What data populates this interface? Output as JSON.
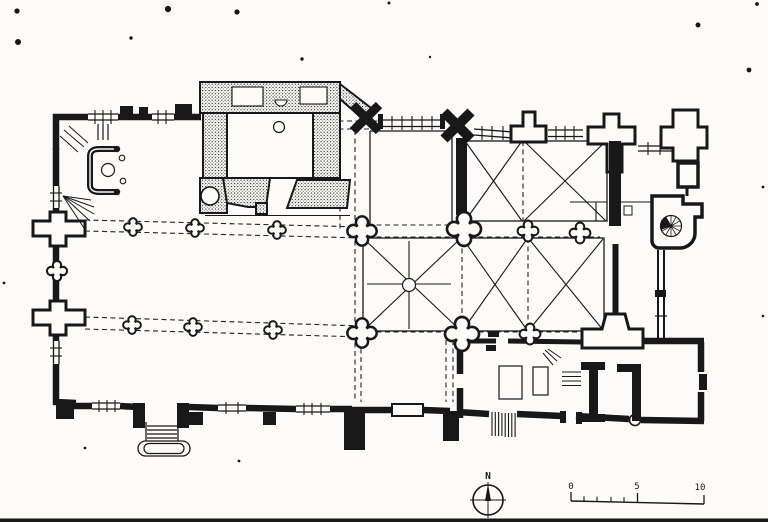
{
  "document": {
    "kind": "scanned architectural floor plan",
    "subject": "church ground plan (nave with aisles, choir with cross-vaulted bays, west apse, stippled chapel block, spiral stair turret, sacristy rooms)"
  },
  "colors": {
    "paper": "#fcfbf9",
    "ink": "#181818",
    "stipple": "#1a1a1a"
  },
  "compass": {
    "north_label": "N"
  },
  "scale_bar": {
    "labels": [
      "0",
      "5",
      "10"
    ],
    "minor_ticks_between_0_and_5": 4
  },
  "icons": [
    "north-compass-icon",
    "spiral-stair-icon",
    "quatrefoil-pier-icon"
  ]
}
